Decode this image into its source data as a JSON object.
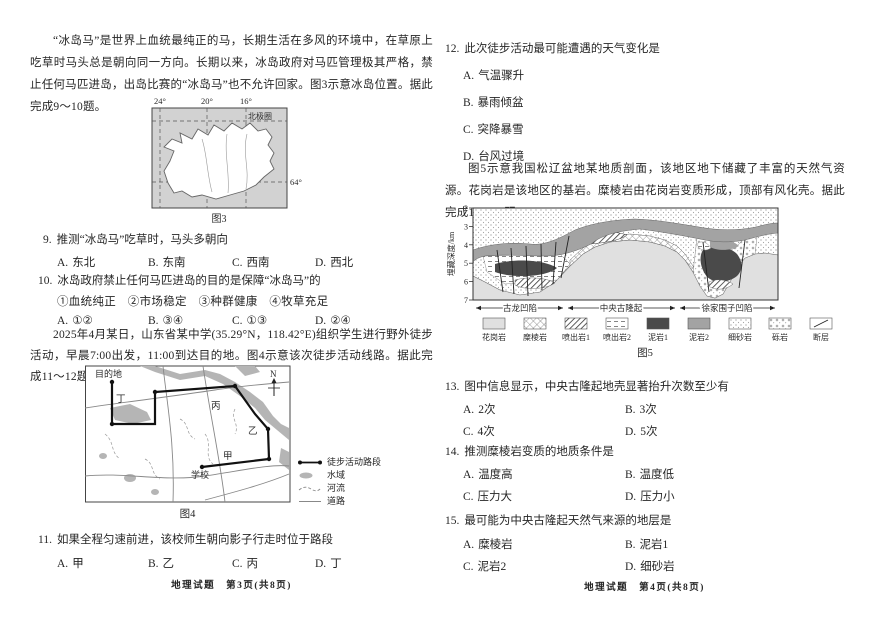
{
  "left_page": {
    "intro_iceland": "“冰岛马”是世界上血统最纯正的马，长期生活在多风的环境中，在草原上吃草时马头总是朝向同一方向。长期以来，冰岛政府对马匹管理极其严格，禁止任何马匹进岛，出岛比赛的“冰岛马”也不允许回家。图3示意冰岛位置。据此完成9～10题。",
    "fig3": {
      "lon_ticks": [
        "24°",
        "20°",
        "16°"
      ],
      "arctic_circle": "北极圈",
      "lat_tick": "64°",
      "caption": "图3"
    },
    "q9": {
      "num": "9.",
      "stem": "推测“冰岛马”吃草时，马头多朝向",
      "options": [
        {
          "k": "A.",
          "v": "东北"
        },
        {
          "k": "B.",
          "v": "东南"
        },
        {
          "k": "C.",
          "v": "西南"
        },
        {
          "k": "D.",
          "v": "西北"
        }
      ]
    },
    "q10": {
      "num": "10.",
      "stem": "冰岛政府禁止任何马匹进岛的目的是保障“冰岛马”的",
      "circled": "①血统纯正　②市场稳定　③种群健康　④牧草充足",
      "options": [
        {
          "k": "A.",
          "v": "①②"
        },
        {
          "k": "B.",
          "v": "③④"
        },
        {
          "k": "C.",
          "v": "①③"
        },
        {
          "k": "D.",
          "v": "②④"
        }
      ]
    },
    "intro_hiking": "2025年4月某日，山东省某中学(35.29°N，118.42°E)组织学生进行野外徒步活动，早晨7:00出发，11:00到达目的地。图4示意该次徒步活动线路。据此完成11～12题。",
    "fig4": {
      "labels": {
        "destination": "目的地",
        "ding": "丁",
        "bing": "丙",
        "yi": "乙",
        "jia": "甲",
        "school": "学校",
        "north": "N"
      },
      "legend": [
        "徒步活动路段",
        "水域",
        "河流",
        "道路"
      ],
      "caption": "图4"
    },
    "q11": {
      "num": "11.",
      "stem": "如果全程匀速前进，该校师生朝向影子行走时位于路段",
      "options": [
        {
          "k": "A.",
          "v": "甲"
        },
        {
          "k": "B.",
          "v": "乙"
        },
        {
          "k": "C.",
          "v": "丙"
        },
        {
          "k": "D.",
          "v": "丁"
        }
      ]
    },
    "footer": "地理试题　第3页(共8页)"
  },
  "right_page": {
    "q12": {
      "num": "12.",
      "stem": "此次徒步活动最可能遭遇的天气变化是",
      "options": [
        {
          "k": "A.",
          "v": "气温骤升"
        },
        {
          "k": "B.",
          "v": "暴雨倾盆"
        },
        {
          "k": "C.",
          "v": "突降暴雪"
        },
        {
          "k": "D.",
          "v": "台风过境"
        }
      ]
    },
    "intro_geology": "图5示意我国松辽盆地某地质剖面，该地区地下储藏了丰富的天然气资源。花岗岩是该地区的基岩。糜棱岩由花岗岩变质形成，顶部有风化壳。据此完成13～15题。",
    "fig5": {
      "y_axis_label": "埋藏深度/km",
      "y_ticks": [
        "2",
        "3",
        "4",
        "5",
        "6",
        "7"
      ],
      "zones": [
        "古龙凹陷",
        "中央古隆起",
        "徐家围子凹陷"
      ],
      "legend": [
        "花岗岩",
        "糜棱岩",
        "喷出岩1",
        "喷出岩2",
        "泥岩1",
        "泥岩2",
        "细砂岩",
        "砾岩",
        "断层"
      ],
      "caption": "图5"
    },
    "q13": {
      "num": "13.",
      "stem": "图中信息显示，中央古隆起地壳显著抬升次数至少有",
      "options": [
        {
          "k": "A.",
          "v": "2次"
        },
        {
          "k": "B.",
          "v": "3次"
        },
        {
          "k": "C.",
          "v": "4次"
        },
        {
          "k": "D.",
          "v": "5次"
        }
      ]
    },
    "q14": {
      "num": "14.",
      "stem": "推测糜棱岩变质的地质条件是",
      "options": [
        {
          "k": "A.",
          "v": "温度高"
        },
        {
          "k": "B.",
          "v": "温度低"
        },
        {
          "k": "C.",
          "v": "压力大"
        },
        {
          "k": "D.",
          "v": "压力小"
        }
      ]
    },
    "q15": {
      "num": "15.",
      "stem": "最可能为中央古隆起天然气来源的地层是",
      "options": [
        {
          "k": "A.",
          "v": "糜棱岩"
        },
        {
          "k": "B.",
          "v": "泥岩1"
        },
        {
          "k": "C.",
          "v": "泥岩2"
        },
        {
          "k": "D.",
          "v": "细砂岩"
        }
      ]
    },
    "footer": "地理试题　第4页(共8页)"
  }
}
